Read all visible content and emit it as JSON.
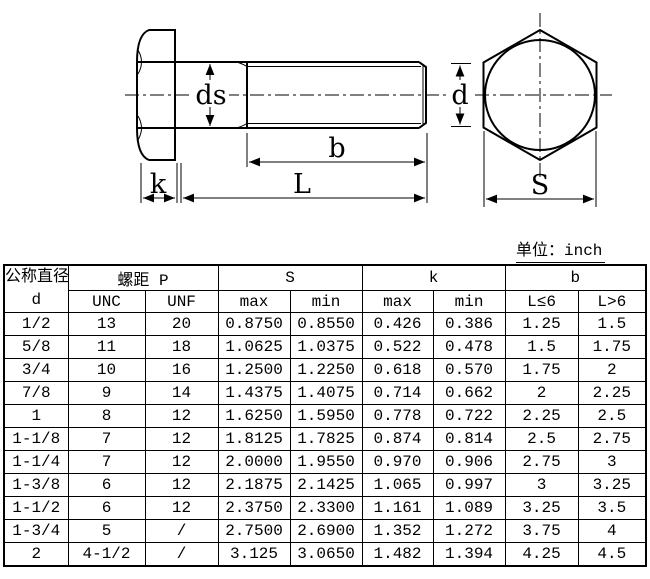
{
  "unit_note": "单位：inch",
  "drawing": {
    "labels": {
      "ds": "ds",
      "b": "b",
      "L": "L",
      "k": "k",
      "d": "d",
      "S": "S"
    }
  },
  "table": {
    "header": {
      "diameter_title": "公称直径",
      "diameter_sub": "d",
      "pitch_title": "螺距 P",
      "pitch_cols": [
        "UNC",
        "UNF"
      ],
      "s_title": "S",
      "s_cols": [
        "max",
        "min"
      ],
      "k_title": "k",
      "k_cols": [
        "max",
        "min"
      ],
      "b_title": "b",
      "b_cols": [
        "L≤6",
        "L>6"
      ]
    },
    "rows": [
      [
        "1/2",
        "13",
        "20",
        "0.8750",
        "0.8550",
        "0.426",
        "0.386",
        "1.25",
        "1.5"
      ],
      [
        "5/8",
        "11",
        "18",
        "1.0625",
        "1.0375",
        "0.522",
        "0.478",
        "1.5",
        "1.75"
      ],
      [
        "3/4",
        "10",
        "16",
        "1.2500",
        "1.2250",
        "0.618",
        "0.570",
        "1.75",
        "2"
      ],
      [
        "7/8",
        "9",
        "14",
        "1.4375",
        "1.4075",
        "0.714",
        "0.662",
        "2",
        "2.25"
      ],
      [
        "1",
        "8",
        "12",
        "1.6250",
        "1.5950",
        "0.778",
        "0.722",
        "2.25",
        "2.5"
      ],
      [
        "1-1/8",
        "7",
        "12",
        "1.8125",
        "1.7825",
        "0.874",
        "0.814",
        "2.5",
        "2.75"
      ],
      [
        "1-1/4",
        "7",
        "12",
        "2.0000",
        "1.9550",
        "0.970",
        "0.906",
        "2.75",
        "3"
      ],
      [
        "1-3/8",
        "6",
        "12",
        "2.1875",
        "2.1425",
        "1.065",
        "0.997",
        "3",
        "3.25"
      ],
      [
        "1-1/2",
        "6",
        "12",
        "2.3750",
        "2.3300",
        "1.161",
        "1.089",
        "3.25",
        "3.5"
      ],
      [
        "1-3/4",
        "5",
        "/",
        "2.7500",
        "2.6900",
        "1.352",
        "1.272",
        "3.75",
        "4"
      ],
      [
        "2",
        "4-1/2",
        "/",
        "3.125",
        "3.0650",
        "1.482",
        "1.394",
        "4.25",
        "4.5"
      ]
    ]
  },
  "colors": {
    "line": "#000000",
    "background": "#ffffff"
  }
}
